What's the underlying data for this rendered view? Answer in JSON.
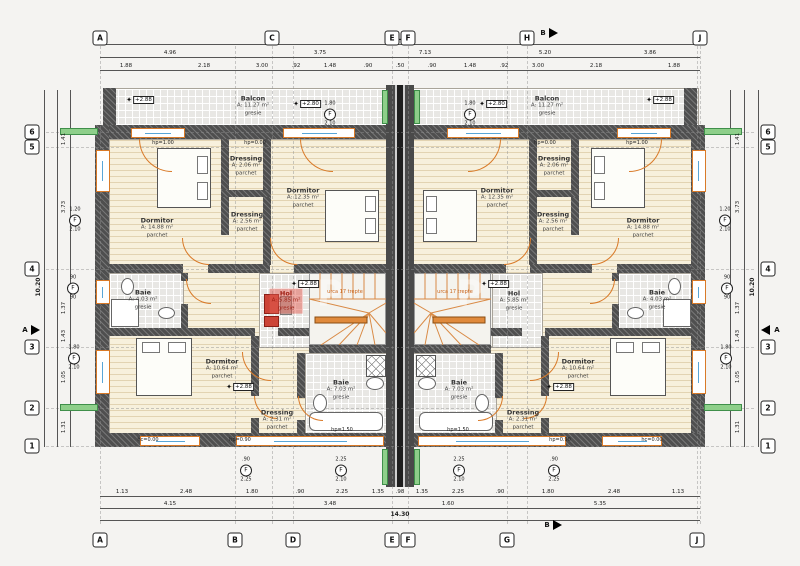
{
  "drawing": {
    "total_width_dim": "14.30",
    "total_height_dim": "10.20"
  },
  "colors": {
    "wall_gray": "#4f4f4f",
    "accent_orange": "#d97a28",
    "insulation_green": "#8ecf8a",
    "highlight_red": "#c0392b",
    "parquet_floor": "#f7f0dc",
    "tile_floor": "#e8e7e4",
    "glazing_blue": "#58a6d8"
  },
  "grid": {
    "top": [
      {
        "label": "A",
        "x": 100
      },
      {
        "label": "C",
        "x": 272
      },
      {
        "label": "E",
        "x": 392
      },
      {
        "label": "F",
        "x": 408
      },
      {
        "label": "H",
        "x": 527
      },
      {
        "label": "J",
        "x": 700
      }
    ],
    "bottom": [
      {
        "label": "A",
        "x": 100
      },
      {
        "label": "B",
        "x": 235
      },
      {
        "label": "D",
        "x": 293
      },
      {
        "label": "E",
        "x": 392
      },
      {
        "label": "F",
        "x": 408
      },
      {
        "label": "G",
        "x": 507
      },
      {
        "label": "J",
        "x": 697
      }
    ],
    "left": [
      {
        "label": "6",
        "y": 132
      },
      {
        "label": "5",
        "y": 147
      },
      {
        "label": "4",
        "y": 269
      },
      {
        "label": "3",
        "y": 347
      },
      {
        "label": "2",
        "y": 408
      },
      {
        "label": "1",
        "y": 446
      }
    ],
    "right": [
      {
        "label": "6",
        "y": 132
      },
      {
        "label": "5",
        "y": 147
      },
      {
        "label": "4",
        "y": 269
      },
      {
        "label": "3",
        "y": 347
      },
      {
        "label": "2",
        "y": 408
      },
      {
        "label": "1",
        "y": 446
      }
    ],
    "sections": [
      {
        "label": "B",
        "x": 553,
        "y": 33,
        "dir": "right"
      },
      {
        "label": "B",
        "x": 557,
        "y": 525,
        "dir": "right"
      },
      {
        "label": "A",
        "x": 35,
        "y": 330,
        "dir": "right"
      },
      {
        "label": "A",
        "x": 765,
        "y": 330,
        "dir": "left"
      }
    ]
  },
  "dims": {
    "top_rows": [
      {
        "y": 57,
        "items": [
          {
            "t": "4.96",
            "x": 170
          },
          {
            "t": "3.75",
            "x": 320
          },
          {
            "t": "7.13",
            "x": 425
          },
          {
            "t": "5.20",
            "x": 545
          },
          {
            "t": "3.86",
            "x": 650
          }
        ]
      },
      {
        "y": 70,
        "items": [
          {
            "t": "1.88",
            "x": 126
          },
          {
            "t": "2.18",
            "x": 204
          },
          {
            "t": "3.00",
            "x": 262
          },
          {
            "t": ".92",
            "x": 296
          },
          {
            "t": "1.48",
            "x": 330
          },
          {
            "t": ".90",
            "x": 368
          },
          {
            "t": ".50",
            "x": 400
          },
          {
            "t": ".90",
            "x": 432
          },
          {
            "t": "1.48",
            "x": 470
          },
          {
            "t": ".92",
            "x": 504
          },
          {
            "t": "3.00",
            "x": 538
          },
          {
            "t": "2.18",
            "x": 596
          },
          {
            "t": "1.88",
            "x": 674
          }
        ]
      }
    ],
    "bottom_rows": [
      {
        "y": 496,
        "items": [
          {
            "t": "1.13",
            "x": 122
          },
          {
            "t": "2.48",
            "x": 186
          },
          {
            "t": "1.80",
            "x": 252
          },
          {
            "t": ".90",
            "x": 300
          },
          {
            "t": "2.25",
            "x": 342
          },
          {
            "t": "1.35",
            "x": 378
          },
          {
            "t": ".98",
            "x": 400
          },
          {
            "t": "1.35",
            "x": 422
          },
          {
            "t": "2.25",
            "x": 458
          },
          {
            "t": ".90",
            "x": 500
          },
          {
            "t": "1.80",
            "x": 548
          },
          {
            "t": "2.48",
            "x": 614
          },
          {
            "t": "1.13",
            "x": 678
          }
        ]
      },
      {
        "y": 508,
        "items": [
          {
            "t": "4.15",
            "x": 170
          },
          {
            "t": "3.48",
            "x": 330
          },
          {
            "t": "1.60",
            "x": 448
          },
          {
            "t": "5.35",
            "x": 600
          }
        ]
      }
    ],
    "left_rows": [
      {
        "x": 70,
        "items": [
          {
            "t": "1.41",
            "y": 139
          },
          {
            "t": "3.73",
            "y": 207
          },
          {
            "t": "1.37",
            "y": 308
          },
          {
            "t": "1.43",
            "y": 336
          },
          {
            "t": "1.05",
            "y": 377
          },
          {
            "t": "1.31",
            "y": 427
          }
        ]
      }
    ],
    "right_rows": [
      {
        "x": 744,
        "items": [
          {
            "t": "1.41",
            "y": 139
          },
          {
            "t": "3.73",
            "y": 207
          },
          {
            "t": "1.37",
            "y": 308
          },
          {
            "t": "1.43",
            "y": 336
          },
          {
            "t": "1.05",
            "y": 377
          },
          {
            "t": "1.31",
            "y": 427
          }
        ]
      }
    ]
  },
  "rooms": [
    {
      "name": "Balcon",
      "area": "A: 11.27 m²",
      "floor": "gresie",
      "x": 253,
      "y": 106
    },
    {
      "name": "Balcon",
      "area": "A: 11.27 m²",
      "floor": "gresie",
      "x": 547,
      "y": 106
    },
    {
      "name": "Dormitor",
      "area": "A: 14.88 m²",
      "floor": "parchet",
      "x": 157,
      "y": 228
    },
    {
      "name": "Dressing",
      "area": "A: 2.06 m²",
      "floor": "parchet",
      "x": 246,
      "y": 166
    },
    {
      "name": "Dressing",
      "area": "A: 2.56 m²",
      "floor": "parchet",
      "x": 247,
      "y": 222
    },
    {
      "name": "Dormitor",
      "area": "A: 12.35 m²",
      "floor": "parchet",
      "x": 303,
      "y": 198
    },
    {
      "name": "Baie",
      "area": "A: 4.03 m²",
      "floor": "gresie",
      "x": 143,
      "y": 300
    },
    {
      "name": "Hol",
      "area": "A: 5.85 m²",
      "floor": "gresie",
      "x": 286,
      "y": 301,
      "highlight": true
    },
    {
      "name": "Dormitor",
      "area": "A: 10.64 m²",
      "floor": "parchet",
      "x": 222,
      "y": 369
    },
    {
      "name": "Dressing",
      "area": "A: 2.31 m²",
      "floor": "parchet",
      "x": 277,
      "y": 420
    },
    {
      "name": "Baie",
      "area": "A: 7.03 m²",
      "floor": "gresie",
      "x": 341,
      "y": 390
    },
    {
      "name": "Dormitor",
      "area": "A: 14.88 m²",
      "floor": "parchet",
      "x": 643,
      "y": 228
    },
    {
      "name": "Dressing",
      "area": "A: 2.06 m²",
      "floor": "parchet",
      "x": 554,
      "y": 166
    },
    {
      "name": "Dressing",
      "area": "A: 2.56 m²",
      "floor": "parchet",
      "x": 553,
      "y": 222
    },
    {
      "name": "Dormitor",
      "area": "A: 12.35 m²",
      "floor": "parchet",
      "x": 497,
      "y": 198
    },
    {
      "name": "Baie",
      "area": "A: 4.03 m²",
      "floor": "gresie",
      "x": 657,
      "y": 300
    },
    {
      "name": "Hol",
      "area": "A: 5.85 m²",
      "floor": "gresie",
      "x": 514,
      "y": 301
    },
    {
      "name": "Dormitor",
      "area": "A: 10.64 m²",
      "floor": "parchet",
      "x": 578,
      "y": 369
    },
    {
      "name": "Dressing",
      "area": "A: 2.31 m²",
      "floor": "parchet",
      "x": 523,
      "y": 420
    },
    {
      "name": "Baie",
      "area": "A: 7.03 m²",
      "floor": "gresie",
      "x": 459,
      "y": 390
    }
  ],
  "levels": [
    {
      "t": "+2.88",
      "x": 140,
      "y": 100
    },
    {
      "t": "+2.80",
      "x": 307,
      "y": 104
    },
    {
      "t": "+2.80",
      "x": 493,
      "y": 104
    },
    {
      "t": "+2.88",
      "x": 660,
      "y": 100
    },
    {
      "t": "+2.88",
      "x": 305,
      "y": 284
    },
    {
      "t": "+2.88",
      "x": 495,
      "y": 284
    },
    {
      "t": "+2.88",
      "x": 240,
      "y": 387
    },
    {
      "t": "+2.88",
      "x": 560,
      "y": 387
    }
  ],
  "windows": [
    {
      "label": "F",
      "w": "1.20",
      "h": "2.10",
      "x": 75,
      "y": 220
    },
    {
      "label": "F",
      "w": "90",
      "h": "90",
      "x": 73,
      "y": 288
    },
    {
      "label": "F",
      "w": "1.80",
      "h": "2.10",
      "x": 74,
      "y": 358
    },
    {
      "label": "F",
      "w": "1.20",
      "h": "2.10",
      "x": 725,
      "y": 220
    },
    {
      "label": "F",
      "w": "90",
      "h": "90",
      "x": 727,
      "y": 288
    },
    {
      "label": "F",
      "w": "1.80",
      "h": "2.10",
      "x": 726,
      "y": 358
    },
    {
      "label": "F",
      "w": "1.80",
      "h": "2.10",
      "x": 330,
      "y": 114
    },
    {
      "label": "F",
      "w": "1.80",
      "h": "2.10",
      "x": 470,
      "y": 114
    },
    {
      "label": "F",
      "w": ".90",
      "h": "2.25",
      "x": 246,
      "y": 470
    },
    {
      "label": "F",
      "w": "2.25",
      "h": "2.10",
      "x": 341,
      "y": 470
    },
    {
      "label": "F",
      "w": "2.25",
      "h": "2.10",
      "x": 459,
      "y": 470
    },
    {
      "label": "F",
      "w": ".90",
      "h": "2.25",
      "x": 554,
      "y": 470
    }
  ],
  "sills": [
    {
      "t": "hp=1.00",
      "x": 163,
      "y": 143
    },
    {
      "t": "hp=1.00",
      "x": 637,
      "y": 143
    },
    {
      "t": "hp=0.00",
      "x": 255,
      "y": 143
    },
    {
      "t": "hp=0.00",
      "x": 545,
      "y": 143
    },
    {
      "t": "hp=1.50",
      "x": 342,
      "y": 430
    },
    {
      "t": "hp=1.50",
      "x": 458,
      "y": 430
    },
    {
      "t": "hc=0.00",
      "x": 148,
      "y": 440
    },
    {
      "t": "hc=0.00",
      "x": 652,
      "y": 440
    },
    {
      "t": "hp=0.90",
      "x": 240,
      "y": 440
    },
    {
      "t": "hp=0.90",
      "x": 560,
      "y": 440
    }
  ],
  "stairs": [
    {
      "note": "urca 17 trepte",
      "x": 345,
      "y": 292
    },
    {
      "note": "urca 17 trepte",
      "x": 455,
      "y": 292
    }
  ],
  "watermark_glyphs": [
    {
      "glyph": "P",
      "x": 330,
      "y": 294
    },
    {
      "glyph": "P",
      "x": 470,
      "y": 294
    }
  ]
}
